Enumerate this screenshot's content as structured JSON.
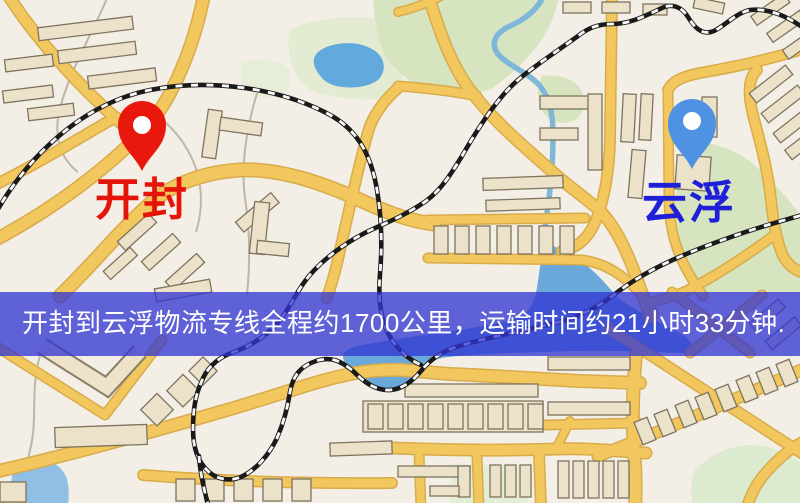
{
  "map": {
    "origin": {
      "name": "开封",
      "icon": "red-location-pin-icon",
      "pin_color": "#e8180c",
      "pin_hole_color": "#ffffff",
      "label_color": "#e51408"
    },
    "destination": {
      "name": "云浮",
      "icon": "blue-location-pin-icon",
      "pin_color": "#4f92e3",
      "pin_hole_color": "#ffffff",
      "label_color": "#1f1fd8"
    },
    "banner": {
      "text": "开封到云浮物流专线全程约1700公里，运输时间约21小时33分钟.",
      "distance_km": "1700",
      "duration_hours": "21",
      "duration_minutes": "33",
      "bg_color": "rgba(48,52,210,0.76)",
      "text_color": "#ffffff"
    },
    "colors": {
      "background": "#f3efe6",
      "road_fill": "#f2c75e",
      "road_casing": "#d8ab4b",
      "building_fill": "#ece2c9",
      "building_stroke": "#7e745f",
      "park_green": "#d6e5c0",
      "water_blue": "#6aa8da",
      "railway_black": "#1a1a1a"
    }
  }
}
